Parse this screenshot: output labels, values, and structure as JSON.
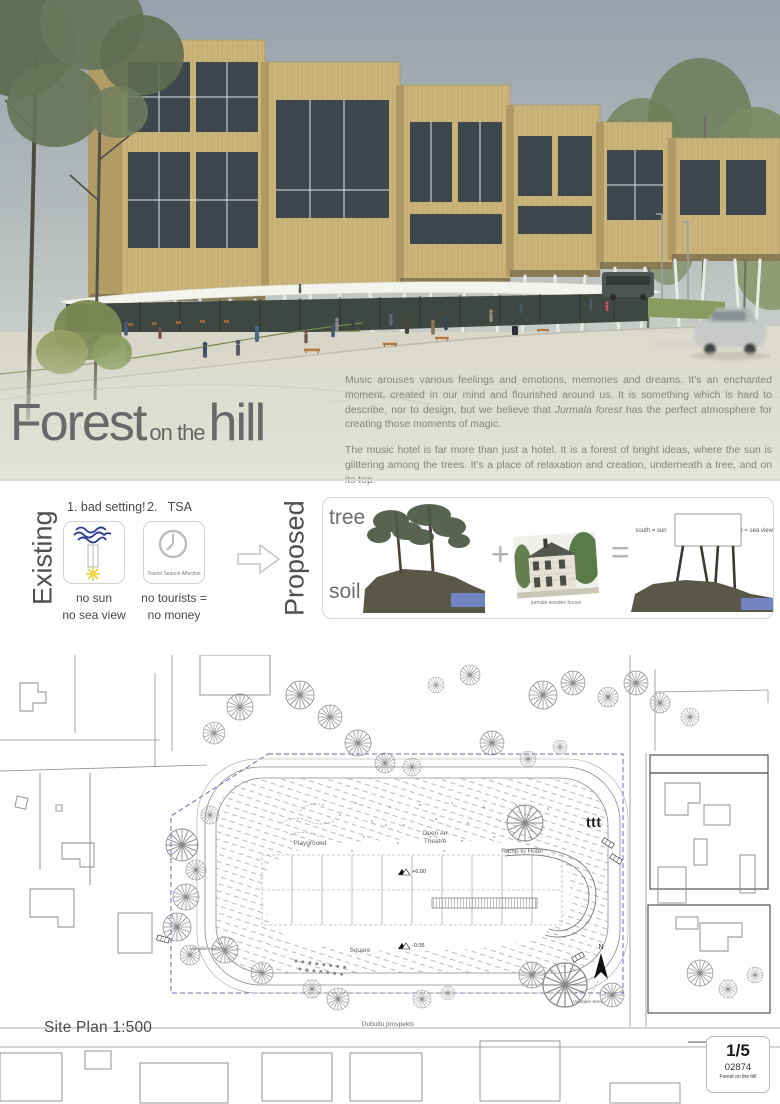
{
  "hero": {
    "title_part1": "Forest",
    "title_part2": "on the",
    "title_part3": "hill",
    "p1_before": "Music arouses various feelings and emotions, memories and dreams. It’s an enchanted moment, created in our mind and flourished around us. It is something which is hard to describe, nor to design, but we believe that ",
    "p1_em": "Jurmala forest",
    "p1_after": " has the perfect atmosphere for creating those moments of magic.",
    "p2": "The music hotel is far more than just a hotel. It is a forest of bright ideas, where the sun is glittering among the trees. It’s a place of relaxation and creation, underneath a tree, and on its top."
  },
  "concept": {
    "existing_label": "Existing",
    "proposed_label": "Proposed",
    "step1_label": "1. bad setting!",
    "step1_caption1": "no sun",
    "step1_caption2": "no sea view",
    "step2_label": "2.   TSA",
    "step2_card_caption": "Tourist Season Affective",
    "step2_caption1": "no tourists =",
    "step2_caption2": "no money",
    "tree_label": "tree",
    "soil_label": "soil",
    "plus_sign": "+",
    "equals_sign": "=",
    "house_caption": "jurmala wooden house",
    "south_label": "south = sun",
    "north_label": "north = sea view"
  },
  "siteplan": {
    "title": "Site Plan 1:500",
    "labels": {
      "playground": "Playground",
      "open_air_1": "Open Air",
      "open_air_2": "Theatre",
      "ramp": "Ramp to Hotel",
      "square": "Square",
      "valuable_trees_left": "valuable trees",
      "valuable_trees_right": "Valuable trees",
      "street": "Dubultu prospekts",
      "ttt": "ttt",
      "north": "N",
      "elev_high": "+6.00",
      "elev_low": "-0.05"
    }
  },
  "titleblock": {
    "page": "1/5",
    "code": "02874",
    "project": "Forest on the hill"
  },
  "colors": {
    "accent_navy": "#2b3a8f",
    "sun_yellow": "#f2d23e",
    "boundary_blue": "#6b6bb5",
    "water_blue": "#7285c2",
    "grass_green": "#8a9b5f",
    "wood_tan": "#cbb479",
    "title_gray": "#69696a"
  }
}
